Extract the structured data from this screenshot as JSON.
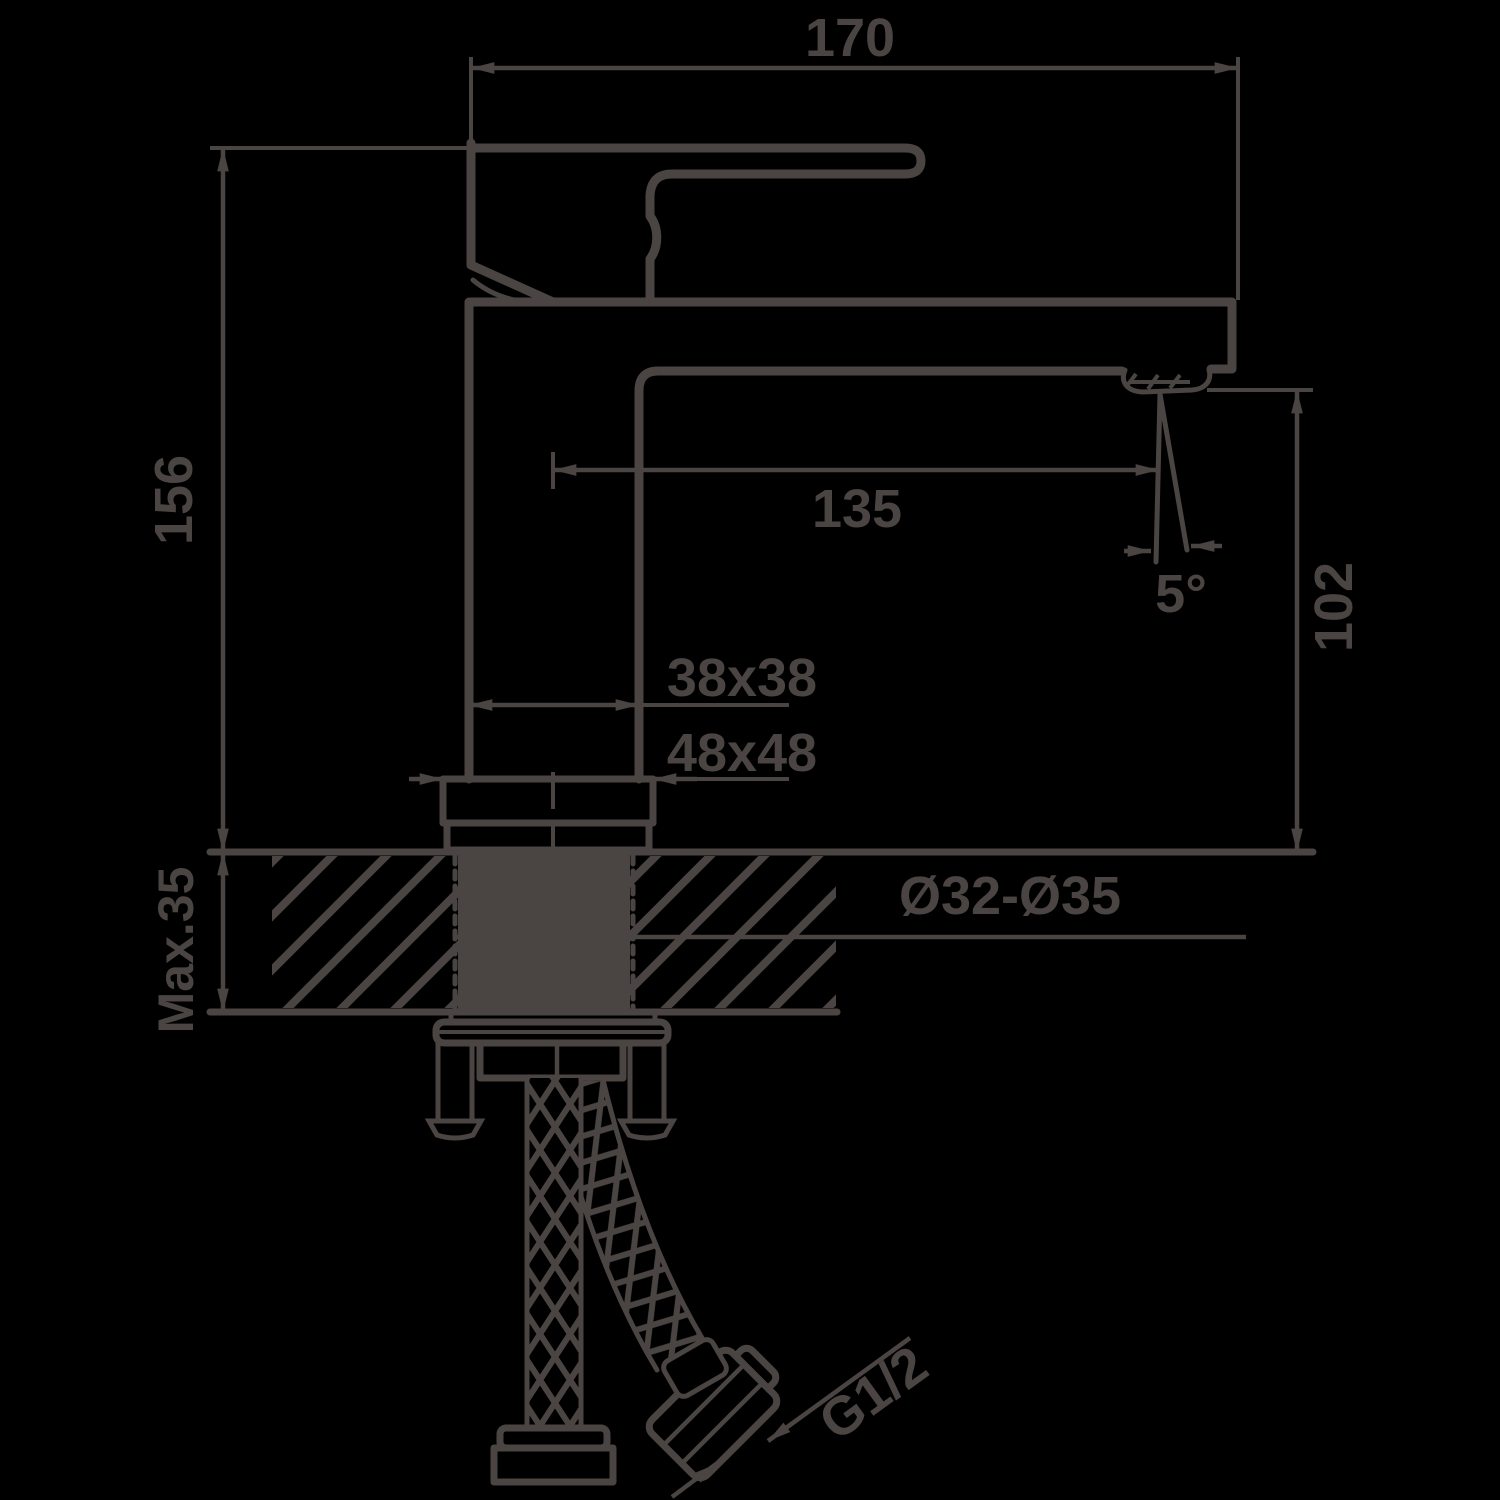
{
  "drawing": {
    "kind": "faucet installation dimension drawing",
    "colors": {
      "ink": "#4a4542",
      "background": "#000000"
    },
    "labels": {
      "overall_width": "170",
      "overall_height": "156",
      "spout_reach": "135",
      "spout_angle": "5°",
      "spout_height": "102",
      "body_cross_section": "38x38",
      "base_cross_section": "48x48",
      "max_counter_thickness": "Max.35",
      "mounting_hole_diameter": "Ø32-Ø35",
      "hose_thread": "G1/2"
    }
  }
}
